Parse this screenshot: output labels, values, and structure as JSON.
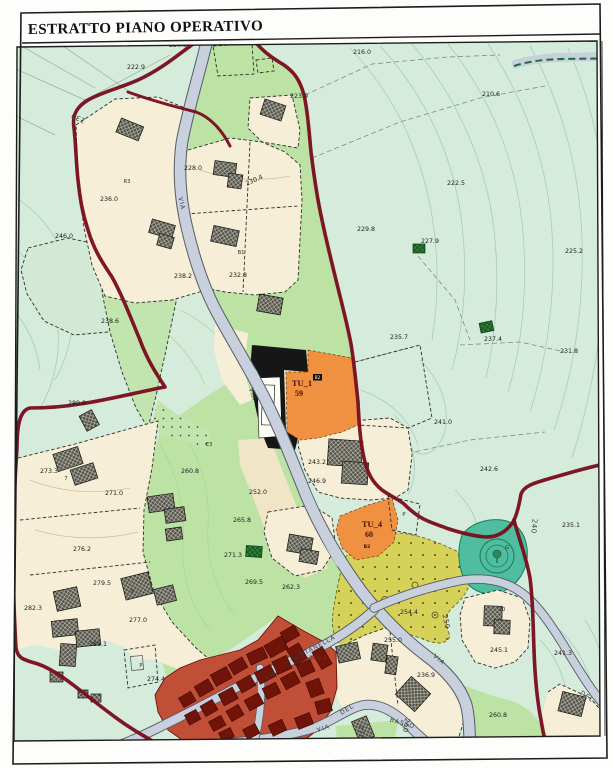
{
  "title": {
    "text": "ESTRATTO PIANO OPERATIVO"
  },
  "zones": {
    "tu1": {
      "code": "TU_1",
      "badge": "B2",
      "number": "59"
    },
    "tu4": {
      "code": "TU_4",
      "badge": "B2",
      "number": "60"
    }
  },
  "labels": {
    "elevations": [
      {
        "t": "220.5",
        "x": 178,
        "y": 47
      },
      {
        "t": "216.0",
        "x": 362,
        "y": 54
      },
      {
        "t": "222.9",
        "x": 136,
        "y": 69
      },
      {
        "t": "223.9",
        "x": 299,
        "y": 98
      },
      {
        "t": "210.6",
        "x": 491,
        "y": 96
      },
      {
        "t": "228.0",
        "x": 193,
        "y": 170
      },
      {
        "t": "230.4",
        "x": 255,
        "y": 182,
        "r": -24
      },
      {
        "t": "222.5",
        "x": 456,
        "y": 185
      },
      {
        "t": "236.0",
        "x": 109,
        "y": 201
      },
      {
        "t": "229.8",
        "x": 366,
        "y": 231
      },
      {
        "t": "227.9",
        "x": 430,
        "y": 243
      },
      {
        "t": "246.0",
        "x": 64,
        "y": 238
      },
      {
        "t": "225.2",
        "x": 574,
        "y": 253
      },
      {
        "t": "238.2",
        "x": 183,
        "y": 278
      },
      {
        "t": "232.8",
        "x": 238,
        "y": 277
      },
      {
        "t": "238.6",
        "x": 110,
        "y": 323
      },
      {
        "t": "235.7",
        "x": 399,
        "y": 339
      },
      {
        "t": "237.4",
        "x": 493,
        "y": 341
      },
      {
        "t": "231.8",
        "x": 569,
        "y": 353
      },
      {
        "t": "289.9",
        "x": 77,
        "y": 405
      },
      {
        "t": "241.0",
        "x": 443,
        "y": 424
      },
      {
        "t": "243.2",
        "x": 317,
        "y": 464
      },
      {
        "t": "242.6",
        "x": 489,
        "y": 471
      },
      {
        "t": "260.8",
        "x": 190,
        "y": 473
      },
      {
        "t": "246.9",
        "x": 317,
        "y": 483
      },
      {
        "t": "273.3",
        "x": 49,
        "y": 473
      },
      {
        "t": "271.0",
        "x": 114,
        "y": 495
      },
      {
        "t": "252.0",
        "x": 258,
        "y": 494
      },
      {
        "t": "235.1",
        "x": 571,
        "y": 527
      },
      {
        "t": "265.8",
        "x": 242,
        "y": 522
      },
      {
        "t": "271.3",
        "x": 233,
        "y": 557
      },
      {
        "t": "276.2",
        "x": 82,
        "y": 551
      },
      {
        "t": "279.5",
        "x": 102,
        "y": 585
      },
      {
        "t": "269.5",
        "x": 254,
        "y": 584
      },
      {
        "t": "262.3",
        "x": 291,
        "y": 589
      },
      {
        "t": "282.3",
        "x": 33,
        "y": 610
      },
      {
        "t": "254.4",
        "x": 409,
        "y": 614
      },
      {
        "t": "277.0",
        "x": 138,
        "y": 622
      },
      {
        "t": "281.1",
        "x": 98,
        "y": 646
      },
      {
        "t": "255.0",
        "x": 393,
        "y": 642
      },
      {
        "t": "245.1",
        "x": 499,
        "y": 652
      },
      {
        "t": "241.3",
        "x": 563,
        "y": 655
      },
      {
        "t": "236.9",
        "x": 426,
        "y": 677
      },
      {
        "t": "274.4",
        "x": 156,
        "y": 681
      },
      {
        "t": "266.2",
        "x": 318,
        "y": 660,
        "c": "lbl-red"
      },
      {
        "t": "260.8",
        "x": 498,
        "y": 717
      }
    ],
    "contour_numbers": [
      {
        "t": "230",
        "x": 79,
        "y": 116,
        "r": 205
      },
      {
        "t": "240",
        "x": 532,
        "y": 526,
        "r": 95
      },
      {
        "t": "250",
        "x": 444,
        "y": 622,
        "r": 78
      },
      {
        "t": "260",
        "x": 404,
        "y": 725,
        "r": 100
      },
      {
        "t": "270",
        "x": 359,
        "y": 732,
        "r": 92
      }
    ],
    "streets": [
      {
        "t": "VIA",
        "x": 272,
        "y": 677,
        "r": -28
      },
      {
        "t": "FONTANELLA",
        "x": 314,
        "y": 650,
        "r": -28
      },
      {
        "t": "VIA",
        "x": 324,
        "y": 730,
        "r": -18
      },
      {
        "t": "DEL",
        "x": 348,
        "y": 711,
        "r": -32
      },
      {
        "t": "BASSO",
        "x": 402,
        "y": 725,
        "r": 16
      },
      {
        "t": "VIA",
        "x": 438,
        "y": 661,
        "r": 40
      },
      {
        "t": "DEL",
        "x": 586,
        "y": 698,
        "r": 36
      },
      {
        "t": "VIA",
        "x": 180,
        "y": 204,
        "r": 78
      },
      {
        "t": "VIA",
        "x": 251,
        "y": 395,
        "r": 72
      }
    ],
    "codes": [
      {
        "t": "R3",
        "x": 127,
        "y": 183
      },
      {
        "t": "B1",
        "x": 241,
        "y": 254
      },
      {
        "t": "E3",
        "x": 209,
        "y": 446
      },
      {
        "t": "P",
        "x": 404,
        "y": 516
      },
      {
        "t": "P",
        "x": 141,
        "y": 667
      },
      {
        "t": "G",
        "x": 507,
        "y": 549
      },
      {
        "t": "7",
        "x": 66,
        "y": 480
      },
      {
        "t": "9",
        "x": 132,
        "y": 593
      },
      {
        "t": "10",
        "x": 502,
        "y": 611
      }
    ]
  },
  "colors": {
    "paper": "#fdfdfb",
    "frame": "#1c1c1c",
    "mint": "#d5ecdc",
    "green": "#bce3a4",
    "tan": "#f6eed6",
    "tan2": "#f0e5c6",
    "road": "#c7d0dc",
    "roadEdge": "#565b64",
    "roadTint": "#b4b9d2",
    "maroon": "#7b0d1e",
    "orange": "#ef9140",
    "yellow": "#d6d158",
    "teal": "#4ebda0",
    "tealDark": "#1f7a55",
    "village": "#c14f38",
    "villageBldg": "#701409",
    "blackZone": "#161616",
    "building": "#52524a",
    "greenParcel": "#2f7d36",
    "contour": "#9fc7ad",
    "contourTan": "#d6bf97",
    "dash": "#2e2e2e",
    "label": "#1d1d1d",
    "tu": "#4a1008",
    "greenDashed": "#1d6e35"
  }
}
